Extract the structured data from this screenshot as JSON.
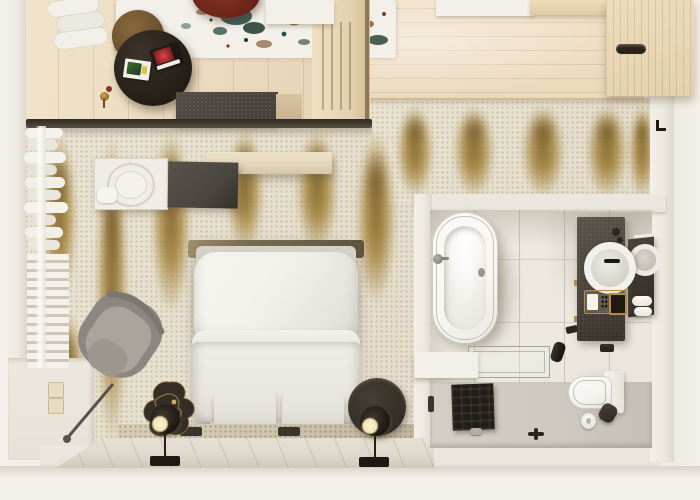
{
  "scene": {
    "description": "Photorealistic top-down 3D render of a hotel room floor plan with lounge, bedroom and en-suite bathroom",
    "view": "top-down cutaway",
    "width_px": 700,
    "height_px": 500,
    "visible_text": ""
  },
  "palette": {
    "bg": "#f3f0e9",
    "wall": "#ece8df",
    "woodLounge": "#e7d5b8",
    "woodEntry": "#f1e1c7",
    "woodPart": "#e3cfae",
    "woodCab": "#e4d0ae",
    "carpet": "#e9e3d3",
    "gold": "#a5853e",
    "goldDark": "#7e6327",
    "rugBase": "#f2f0e9",
    "splatTeal": "#24514a",
    "splatGreen": "#1c3a30",
    "splatBrown": "#74451f",
    "splatRust": "#8a3820",
    "tableDark": "#241d16",
    "stool": "#6f5430",
    "maroon": "#6b241a",
    "benchDark": "#44403a",
    "benchTan": "#d8c3a2",
    "shelfWhite": "#f0ede6",
    "panelDark": "#4b4740",
    "stoneShelf": "#e2d6bd",
    "headboard": "#7d7050",
    "bedFrame": "#d6d2c9",
    "pillow": "#f2f0eb",
    "duvet": "#eae7e0",
    "cushion": "#e3e0d8",
    "footRug": "#cfc4ad",
    "stone": "#ded9cc",
    "lampDark": "#1c1813",
    "lampGlow": "#f5e3b5",
    "chairShell": "#8b867f",
    "chairSeat": "#a8a39b",
    "tableBronze": "#342e26",
    "curtain": "#f2efe8",
    "tile": "#e9e5dc",
    "tub": "#f7f6f2",
    "vanity": "#4d463d",
    "showerFloor": "#cdc9c0",
    "mat": "#211d18",
    "toilet": "#f4f3ef",
    "switchCream": "#e8ddc2",
    "brass": "#b08b4a"
  },
  "rooms": [
    {
      "id": "lounge",
      "label": "Lounge seating area"
    },
    {
      "id": "hall",
      "label": "Entry hall"
    },
    {
      "id": "bedroom",
      "label": "Bedroom"
    },
    {
      "id": "bathroom",
      "label": "En-suite bathroom"
    }
  ],
  "objects": [
    {
      "id": "splatter-rug",
      "room": "lounge",
      "label": "White rug with teal and brown paint-splatter pattern"
    },
    {
      "id": "coffee-table",
      "room": "lounge",
      "label": "Round dark coffee table with two magazines"
    },
    {
      "id": "magazine-red",
      "room": "lounge",
      "label": "Magazine with red cover"
    },
    {
      "id": "magazine-green",
      "room": "lounge",
      "label": "Magazine with green cover"
    },
    {
      "id": "bronze-stool",
      "room": "lounge",
      "label": "Round bronze stool"
    },
    {
      "id": "maroon-chair",
      "room": "lounge",
      "label": "Dark red lounge chair"
    },
    {
      "id": "bench",
      "room": "lounge",
      "label": "Dark upholstered bench"
    },
    {
      "id": "slat-partition",
      "room": "lounge",
      "label": "Wood slat partition wall"
    },
    {
      "id": "wardrobe",
      "room": "hall",
      "label": "Wood wardrobe cabinet with recessed handle"
    },
    {
      "id": "entry-door",
      "room": "hall",
      "label": "Entry door threshold"
    },
    {
      "id": "gold-carpet",
      "room": "bedroom",
      "label": "Cream carpet with gold ikat streaks"
    },
    {
      "id": "bed",
      "room": "bedroom",
      "label": "Double bed with white pillow and duvet"
    },
    {
      "id": "foot-cushions",
      "room": "bedroom",
      "label": "Two cushions at foot of bed"
    },
    {
      "id": "nightstand-left",
      "room": "bedroom",
      "label": "Organic bronze side table"
    },
    {
      "id": "nightstand-right",
      "room": "bedroom",
      "label": "Round dark side table"
    },
    {
      "id": "floor-lamp-left",
      "room": "bedroom",
      "label": "Floor lamp with glowing ring head"
    },
    {
      "id": "floor-lamp-right",
      "room": "bedroom",
      "label": "Floor lamp with glowing ring head"
    },
    {
      "id": "armchair",
      "room": "bedroom",
      "label": "Gray swivel armchair"
    },
    {
      "id": "shelf-unit",
      "room": "bedroom",
      "label": "White console with round decorative tray"
    },
    {
      "id": "media-panel",
      "room": "bedroom",
      "label": "Dark flat panel"
    },
    {
      "id": "wall-shelf",
      "room": "bedroom",
      "label": "Floating stone shelf"
    },
    {
      "id": "curtains",
      "room": "bedroom",
      "label": "Sheer curtains along window wall"
    },
    {
      "id": "shutter",
      "room": "bedroom",
      "label": "Louvered shutter panel"
    },
    {
      "id": "light-switch",
      "room": "bedroom",
      "label": "Wall switch plate"
    },
    {
      "id": "stone-ledge",
      "room": "bedroom",
      "label": "Stone ledge at foot of bed"
    },
    {
      "id": "bathtub",
      "room": "bathroom",
      "label": "Freestanding oval bathtub"
    },
    {
      "id": "shower-bench",
      "room": "bathroom",
      "label": "Glass shower bench"
    },
    {
      "id": "shower-mat",
      "room": "bathroom",
      "label": "Black shower mat"
    },
    {
      "id": "floor-drain",
      "room": "bathroom",
      "label": "Linear floor drain"
    },
    {
      "id": "toilet",
      "room": "bathroom",
      "label": "Wall-hung toilet"
    },
    {
      "id": "toilet-paper",
      "room": "bathroom",
      "label": "Toilet paper roll"
    },
    {
      "id": "vanity",
      "room": "bathroom",
      "label": "Dark stone vanity with round vessel sink"
    },
    {
      "id": "sink-faucet",
      "room": "bathroom",
      "label": "Black sink faucet"
    },
    {
      "id": "amenity-tray",
      "room": "bathroom",
      "label": "Brass amenity tray"
    },
    {
      "id": "mirror",
      "room": "bathroom",
      "label": "Round mirror on dark panel"
    },
    {
      "id": "towels",
      "room": "bathroom",
      "label": "Rolled white towels"
    },
    {
      "id": "wall-tap",
      "room": "bathroom",
      "label": "Black wall-mounted tap"
    }
  ]
}
